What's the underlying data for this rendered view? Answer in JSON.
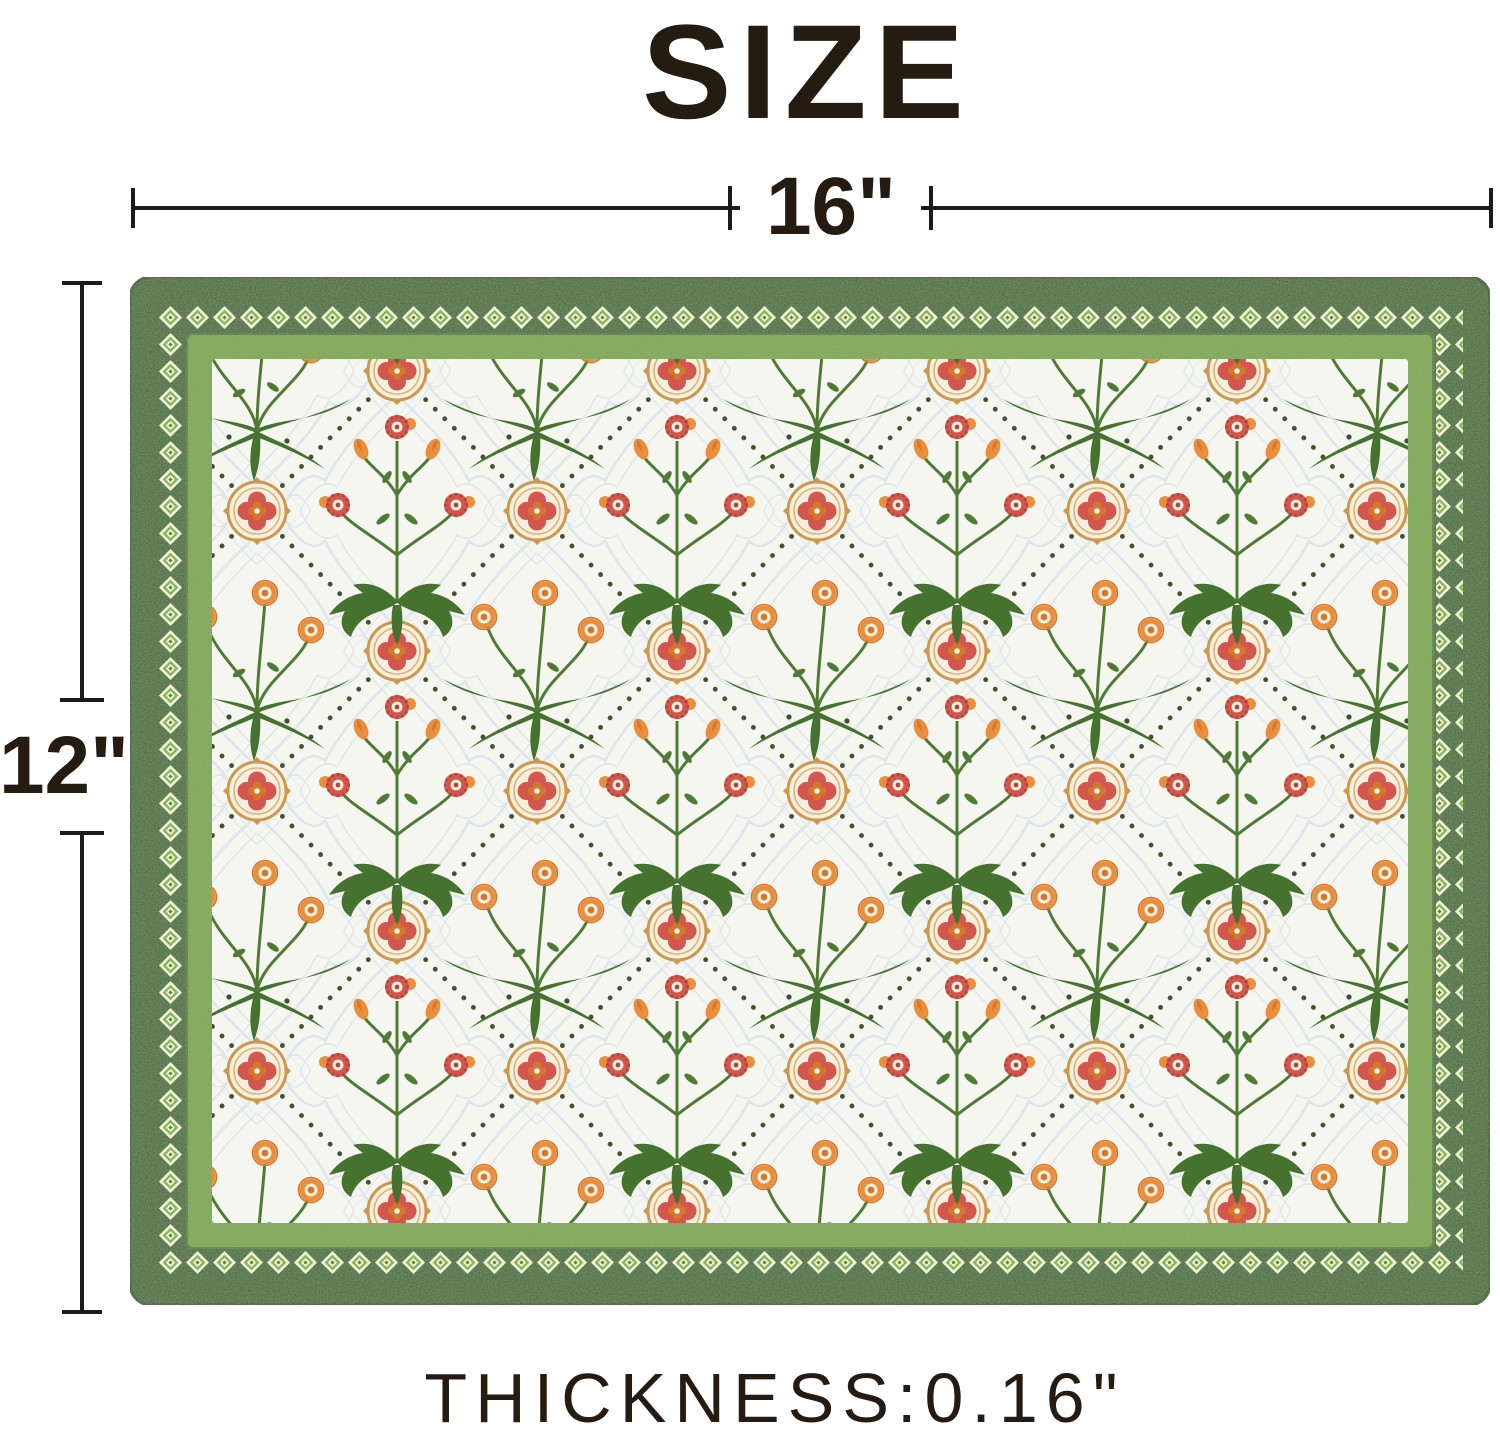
{
  "title": "SIZE",
  "dimensions": {
    "width_label": "16\"",
    "height_label": "12\"",
    "thickness_label": "THICKNESS:0.16\""
  },
  "placemat": {
    "shape": "rounded rectangle placemat",
    "border_style": "dark green band with diamond chain, light green inner frame",
    "interior_style": "white ground, dotted diamond lattice, medallions, floral bouquets and orange pompom sprigs"
  },
  "colors": {
    "text-color": "#261b10",
    "line-color": "#1d1b18",
    "border-green": "#45653a",
    "border-green-edge": "#314d2a",
    "frame-green": "#7fa84f",
    "frame-green-edge": "#55793a",
    "interior-bg": "#f4f6ef",
    "diamond-cream": "#eff4da",
    "diamond-green": "#8cb257",
    "diamond-green-dark": "#5d8340",
    "emboss": "#dfe6ec",
    "dot-green": "#44522f",
    "medallion-gold": "#cc9ا84f",
    "gold": "#cc984f",
    "gold-light": "#ddb47c",
    "cream": "#f8f0de",
    "flower-red": "#d4574e",
    "flower-red-dark": "#b2443a",
    "flower-orange": "#e98e3d",
    "flower-orange-deep": "#d3772c",
    "leaf-green": "#4e7a36",
    "leaf-green-dark": "#46722f"
  }
}
